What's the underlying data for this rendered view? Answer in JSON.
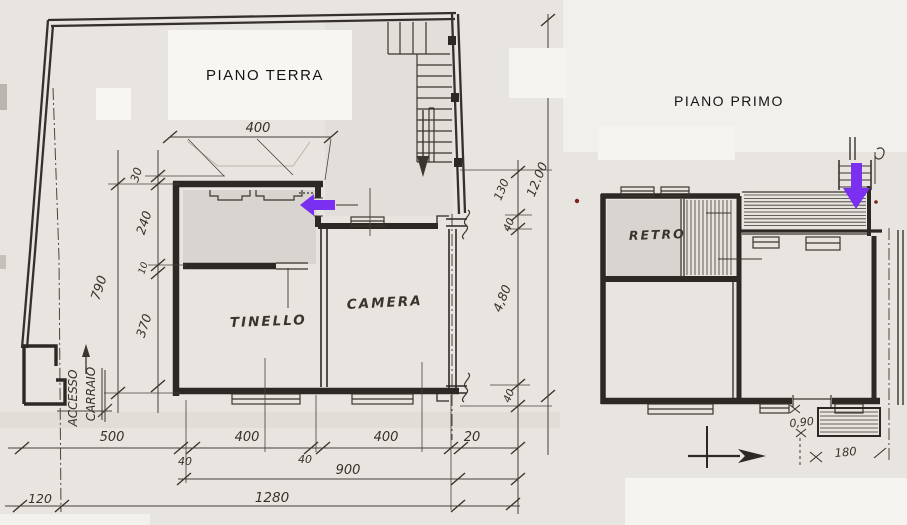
{
  "palette": {
    "paper": "#e8e5e0",
    "ink": "#3b352e",
    "wall": "#2c2824",
    "accent_purple": "#7b2ff0",
    "red_dot": "#7c241c",
    "patch_white": "#f7f6f3"
  },
  "piano_terra": {
    "title": "PIANO TERRA",
    "room_labels": {
      "tinello": "TINELLO",
      "camera": "CAMERA"
    },
    "access_label": {
      "line1": "ACCESSO",
      "line2": "CARRAIO"
    },
    "dims": {
      "top_width": "400",
      "left_chain": [
        "30",
        "240",
        "10",
        "370"
      ],
      "left_total": "790",
      "right_chain": [
        "130",
        "40",
        "4,80",
        "40"
      ],
      "right_total": "12.00",
      "bottom_row1": [
        "500",
        "400",
        "400",
        "20"
      ],
      "bottom_wall_thickness": [
        "40",
        "40"
      ],
      "bottom_row2": "900",
      "bottom_row3": "1280",
      "bottom_left_offset": "120"
    }
  },
  "piano_primo": {
    "title": "PIANO PRIMO",
    "room_labels": {
      "retro": "RETRO"
    },
    "dims": {
      "door_width": "0,90",
      "balcony_width": "180"
    }
  }
}
